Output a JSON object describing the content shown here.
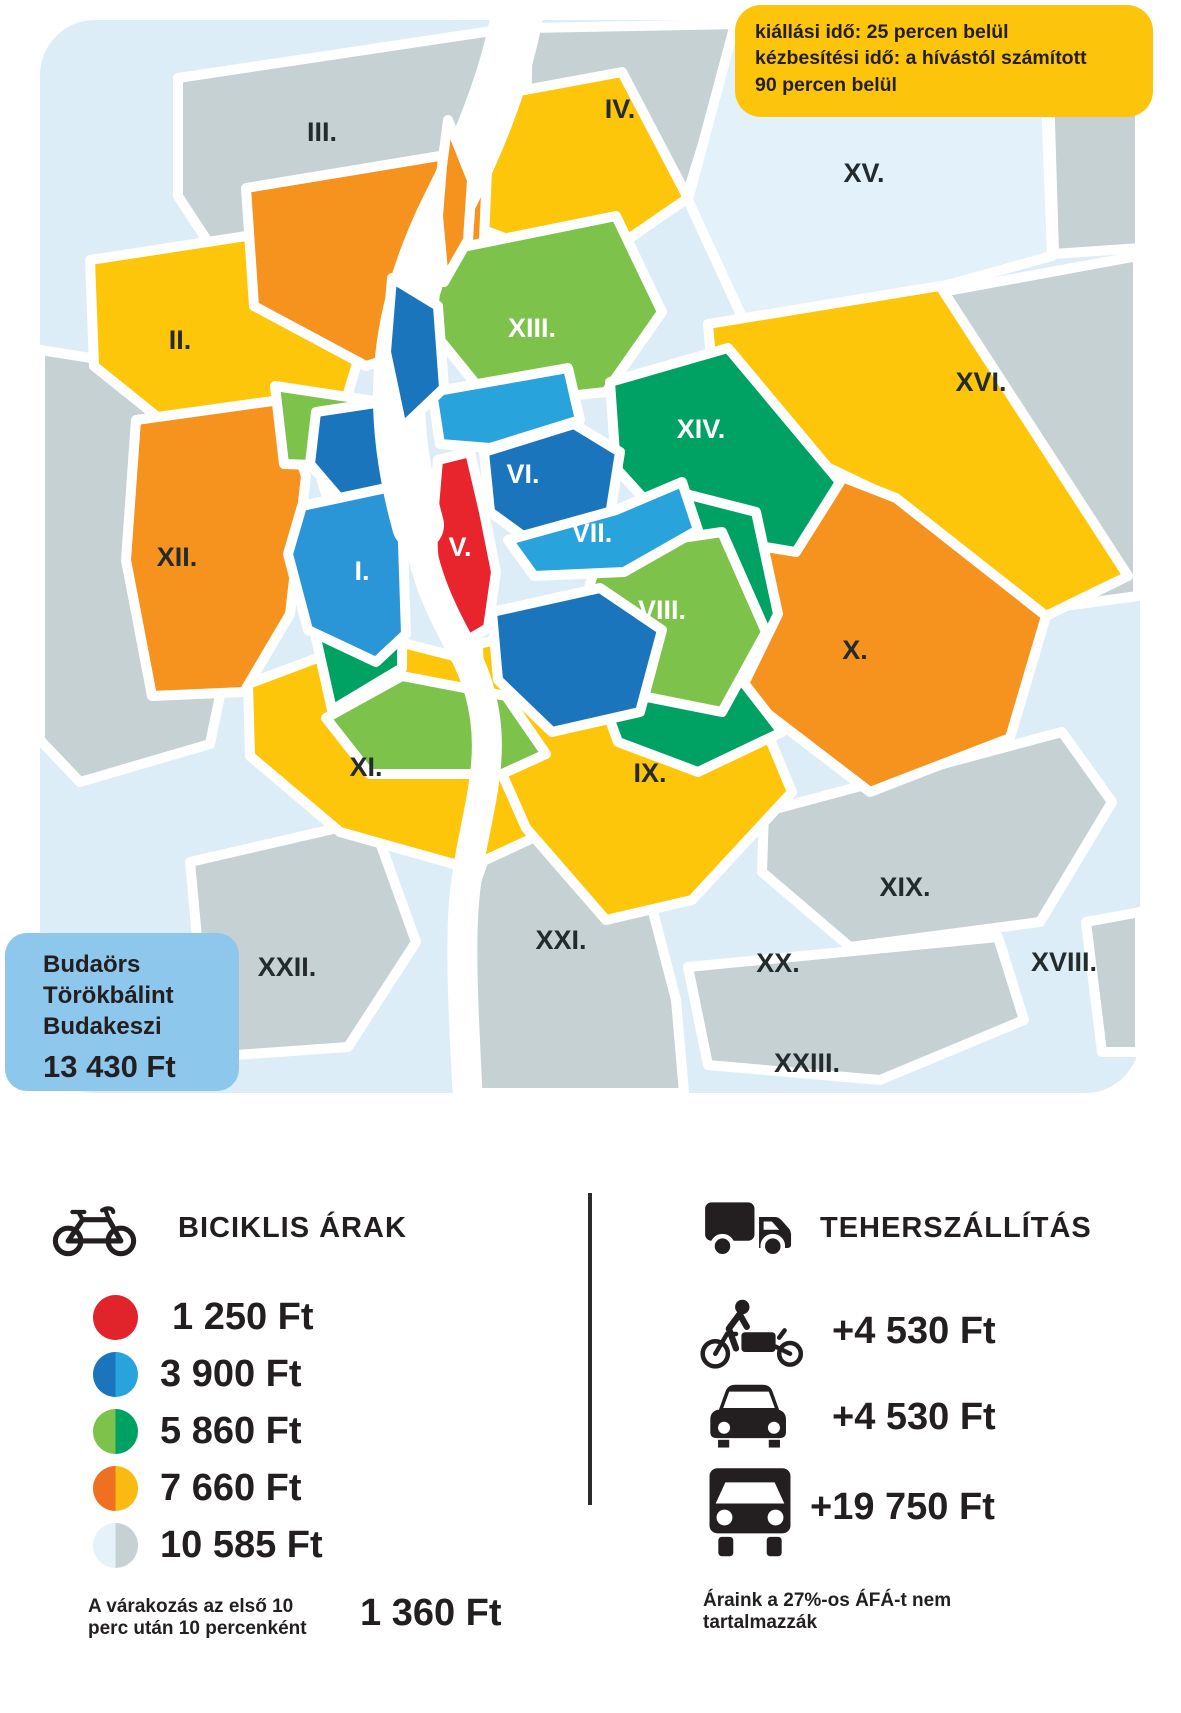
{
  "delivery_info_box": {
    "bg_color": "#fcc40a",
    "lines": [
      "kiállási idő: 25 percen belül",
      "kézbesítési idő: a hívástól számított",
      "90 percen belül"
    ]
  },
  "outside_zone_box": {
    "bg_color": "#8dc7ec",
    "towns": [
      "Budaörs",
      "Törökbálint",
      "Budakeszi"
    ],
    "price": "13 430 Ft"
  },
  "map": {
    "districts": [
      {
        "label": "I."
      },
      {
        "label": "II."
      },
      {
        "label": "III."
      },
      {
        "label": "IV."
      },
      {
        "label": "V."
      },
      {
        "label": "VI."
      },
      {
        "label": "VII."
      },
      {
        "label": "VIII."
      },
      {
        "label": "IX."
      },
      {
        "label": "X."
      },
      {
        "label": "XI."
      },
      {
        "label": "XII."
      },
      {
        "label": "XIII."
      },
      {
        "label": "XIV."
      },
      {
        "label": "XV."
      },
      {
        "label": "XVI."
      },
      {
        "label": "XVIII."
      },
      {
        "label": "XIX."
      },
      {
        "label": "XX."
      },
      {
        "label": "XXI."
      },
      {
        "label": "XXII."
      },
      {
        "label": "XXIII."
      }
    ],
    "zone_colors": {
      "red": "#e8242c",
      "dark_blue": "#1b75bc",
      "medium_blue": "#2a96d8",
      "light_blue": "#29a3dc",
      "light_green": "#7dc24b",
      "dark_green": "#00a264",
      "orange": "#f6921e",
      "yellow": "#fdc60b",
      "pale_blue": "#ddedf7",
      "gray": "#c5d1d2"
    }
  },
  "bike_prices": {
    "title": "BICIKLIS ÁRAK",
    "tiers": [
      {
        "price": "1 250 Ft",
        "color_left": "#e1242b",
        "color_right": "#e1242b"
      },
      {
        "price": "3 900 Ft",
        "color_left": "#1b75bc",
        "color_right": "#29a3dc"
      },
      {
        "price": "5 860 Ft",
        "color_left": "#7dc24b",
        "color_right": "#00a264"
      },
      {
        "price": "7 660 Ft",
        "color_left": "#ef7020",
        "color_right": "#f9bb10"
      },
      {
        "price": "10 585 Ft",
        "color_left": "#e6f2f9",
        "color_right": "#c5d1d2"
      }
    ],
    "waiting_note": [
      "A várakozás az első 10",
      "perc után 10 percenként"
    ],
    "waiting_price": "1 360 Ft"
  },
  "freight": {
    "title": "TEHERSZÁLLÍTÁS",
    "rows": [
      {
        "vehicle": "cargo-bike",
        "price": "+4 530 Ft"
      },
      {
        "vehicle": "car",
        "price": "+4 530 Ft"
      },
      {
        "vehicle": "truck",
        "price": "+19 750 Ft"
      }
    ],
    "vat_note": [
      "Áraink a 27%-os ÁFÁ-t nem",
      "tartalmazzák"
    ]
  }
}
